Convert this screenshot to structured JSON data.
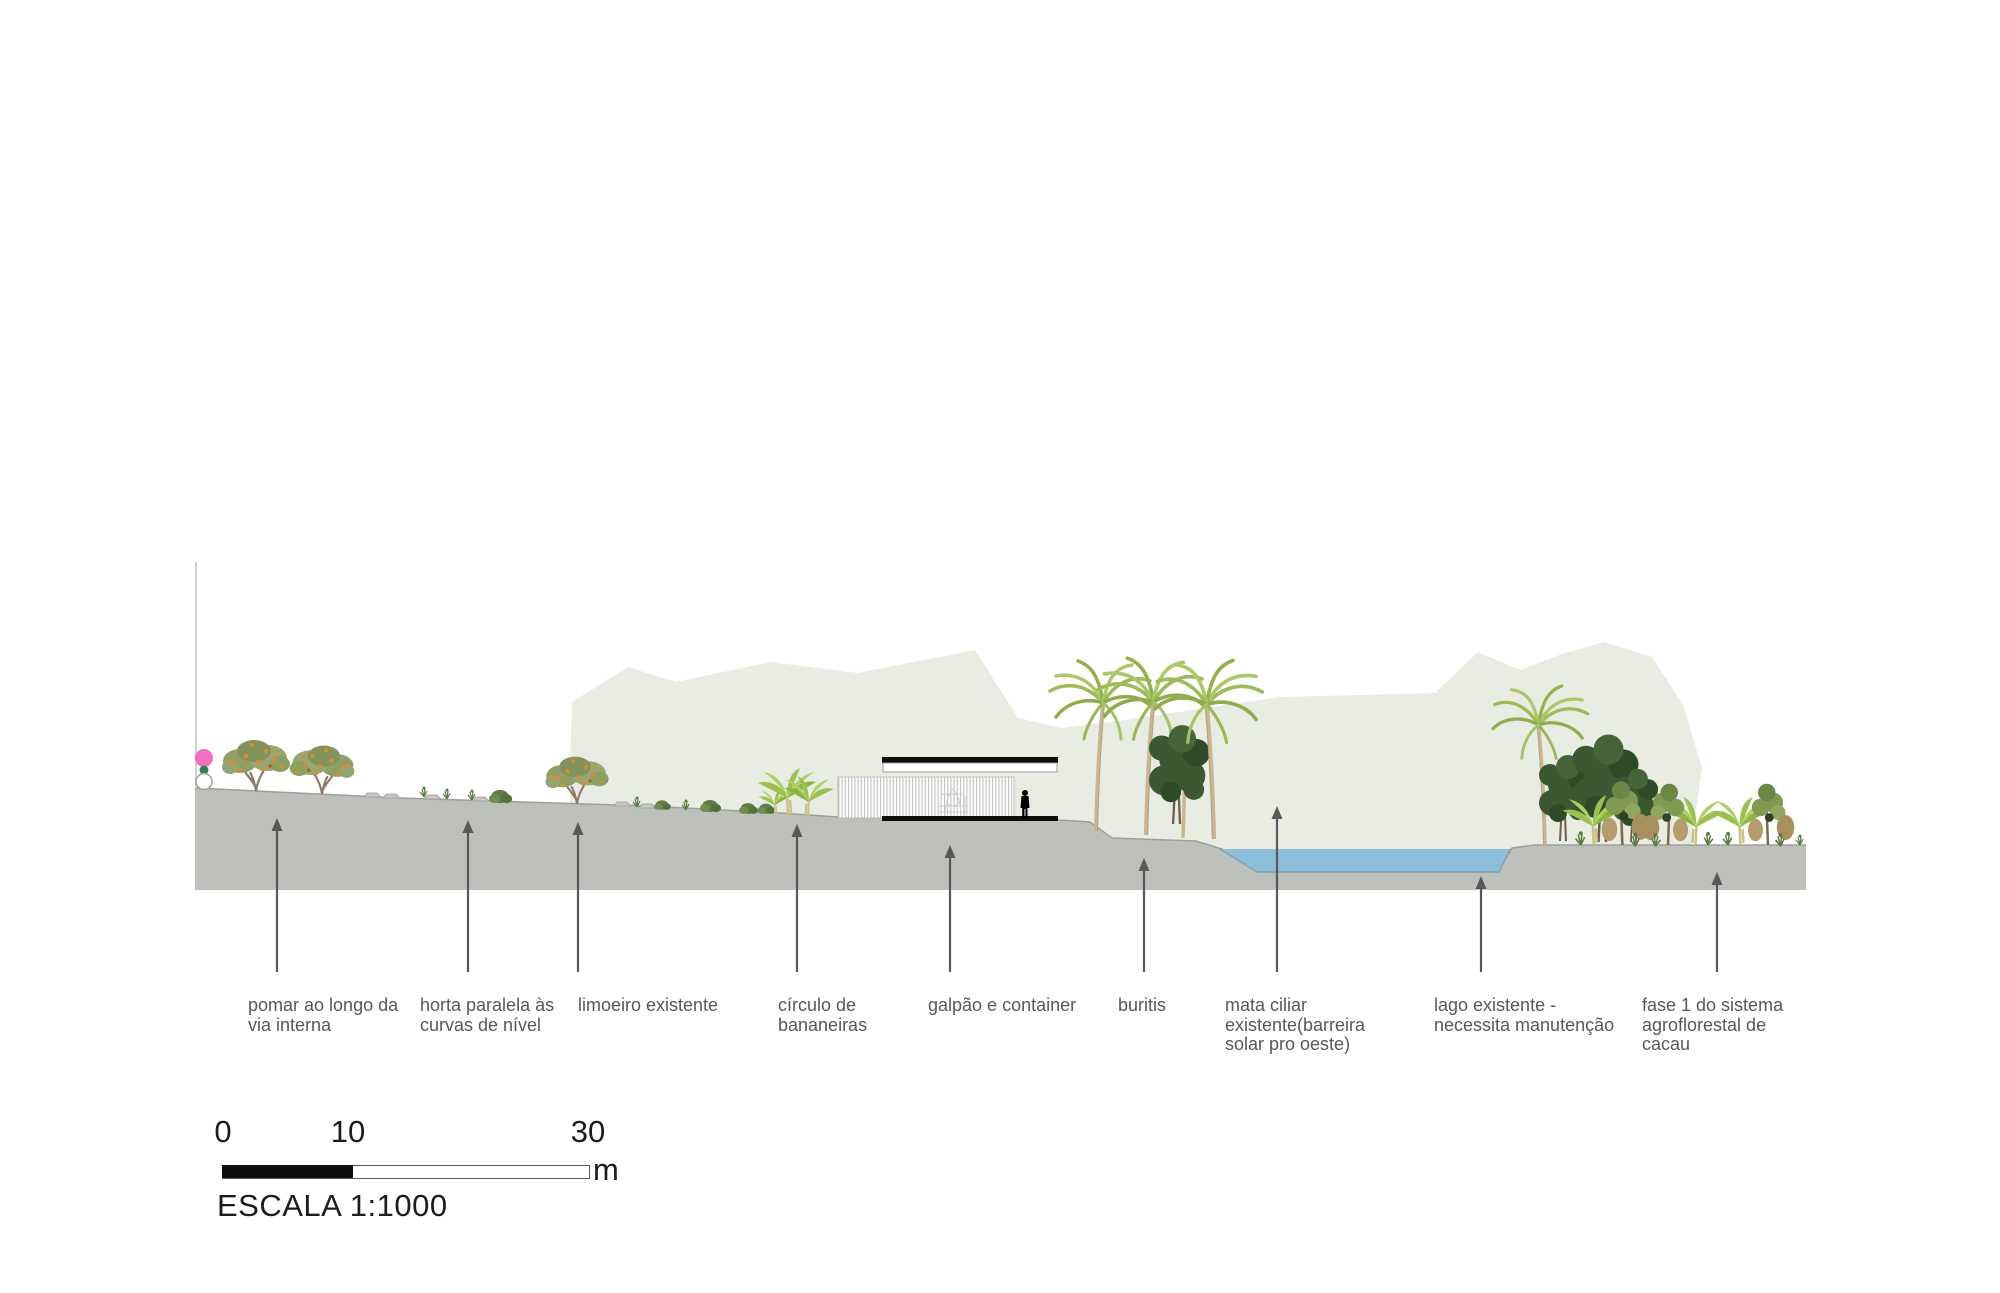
{
  "colors": {
    "ground": "#bec0bb",
    "ground_edge": "#9da09a",
    "hill": "#e8ece2",
    "water": "#8dbeda",
    "water_edge": "#7b9fb5",
    "annotation": "#57585a",
    "scale_text": "#1c1c1c",
    "marker_pink": "#f06fc0",
    "cut_line": "#d2d2d2"
  },
  "annotations": [
    {
      "name": "pomar",
      "text": "pomar ao longo da\nvia interna",
      "label_x": 248,
      "arrow_x": 277,
      "head_y": 818
    },
    {
      "name": "horta",
      "text": "horta paralela às\ncurvas de nível",
      "label_x": 420,
      "arrow_x": 468,
      "head_y": 820
    },
    {
      "name": "limoeiro",
      "text": "limoeiro existente",
      "label_x": 578,
      "arrow_x": 578,
      "head_y": 822
    },
    {
      "name": "circulo",
      "text": "círculo de\nbananeiras",
      "label_x": 778,
      "arrow_x": 797,
      "head_y": 824
    },
    {
      "name": "galpao",
      "text": "galpão e container",
      "label_x": 928,
      "arrow_x": 950,
      "head_y": 845
    },
    {
      "name": "buritis",
      "text": "buritis",
      "label_x": 1118,
      "arrow_x": 1144,
      "head_y": 858
    },
    {
      "name": "mata-ciliar",
      "text": "mata ciliar\nexistente(barreira\nsolar pro oeste)",
      "label_x": 1225,
      "arrow_x": 1277,
      "head_y": 806
    },
    {
      "name": "lago",
      "text": "lago existente -\nnecessita manutenção",
      "label_x": 1434,
      "arrow_x": 1481,
      "head_y": 876
    },
    {
      "name": "fase1",
      "text": "fase 1 do sistema\nagroflorestal de\ncacau",
      "label_x": 1642,
      "arrow_x": 1717,
      "head_y": 872
    }
  ],
  "scale_bar": {
    "tick_start": "0",
    "tick_mid": "10",
    "tick_end": "30",
    "unit": "m",
    "caption": "ESCALA 1:1000"
  }
}
